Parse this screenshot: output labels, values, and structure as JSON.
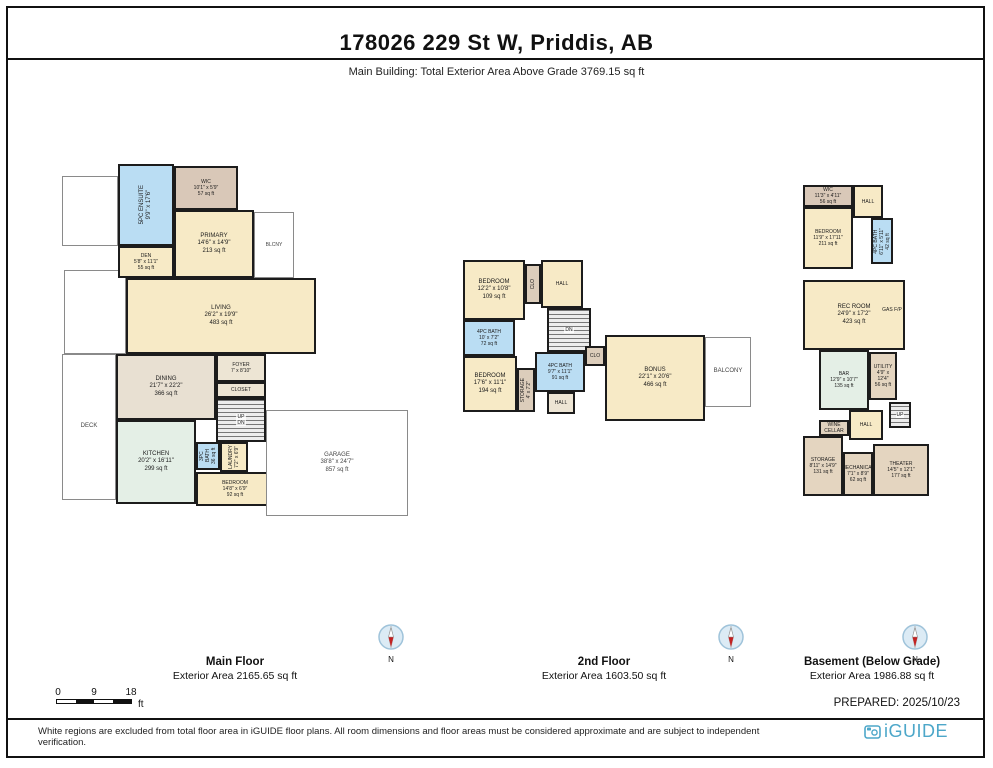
{
  "header": {
    "title": "178026 229 St W, Priddis, AB",
    "subtitle": "Main Building: Total Exterior Area Above Grade 3769.15 sq ft"
  },
  "compass": {
    "north_label": "N"
  },
  "scale_bar": {
    "ticks": [
      "0",
      "9",
      "18"
    ],
    "unit": "ft"
  },
  "prepared": "PREPARED: 2025/10/23",
  "footer": {
    "disclaimer": "White regions are excluded from total floor area in iGUIDE floor plans. All room dimensions and floor areas must be considered approximate and are subject to independent verification.",
    "logo_text": "iGUIDE"
  },
  "colors": {
    "room_cream": "#F7EAC6",
    "bath_blue": "#BADDF3",
    "closet_tan": "#DCCDBB",
    "hall_tan": "#EDE5D4",
    "dining_taupe": "#E8E0D2",
    "kitchen_mint": "#E4EFE6",
    "basement_tan": "#E4D5C0",
    "logo_blue": "#4DA7C9",
    "compass_red": "#C22222",
    "wall": "#1C1C1C"
  },
  "floors": [
    {
      "id": "main-floor",
      "caption_title": "Main Floor",
      "caption_area": "Exterior Area 2165.65 sq ft",
      "plan": {
        "left": 60,
        "top": 150,
        "width": 360,
        "height": 372
      },
      "rooms": [
        {
          "id": "deck-upper-region",
          "kind": "open",
          "lines": [],
          "x": 2,
          "y": 26,
          "w": 56,
          "h": 70
        },
        {
          "id": "deck-mid-region",
          "kind": "open",
          "lines": [],
          "x": 4,
          "y": 120,
          "w": 62,
          "h": 84
        },
        {
          "id": "deck",
          "kind": "open",
          "lines": [
            "DECK"
          ],
          "x": 2,
          "y": 204,
          "w": 54,
          "h": 146
        },
        {
          "id": "ensuite-5pc",
          "kind": "room",
          "vertical": true,
          "lines": [
            "5PC ENSUITE",
            "9'9\" x 17'6\""
          ],
          "x": 58,
          "y": 14,
          "w": 56,
          "h": 82,
          "fill": "#BADDF3"
        },
        {
          "id": "wic-main",
          "kind": "room",
          "lines": [
            "WIC",
            "10'1\" x 5'9\"",
            "57 sq ft"
          ],
          "x": 114,
          "y": 16,
          "w": 64,
          "h": 44,
          "fill": "#D9C8B8",
          "fs": 5
        },
        {
          "id": "primary-bedroom",
          "kind": "room",
          "lines": [
            "PRIMARY",
            "14'6\" x 14'9\"",
            "213 sq ft"
          ],
          "x": 114,
          "y": 60,
          "w": 80,
          "h": 68,
          "fill": "#F7EAC6"
        },
        {
          "id": "balcony-main",
          "kind": "open",
          "lines": [
            "BLCNY"
          ],
          "x": 194,
          "y": 62,
          "w": 40,
          "h": 66,
          "fs": 5
        },
        {
          "id": "den",
          "kind": "room",
          "lines": [
            "DEN",
            "5'8\" x 11'1\"",
            "55 sq ft"
          ],
          "x": 58,
          "y": 96,
          "w": 56,
          "h": 32,
          "fill": "#F7EAC6",
          "fs": 5
        },
        {
          "id": "living",
          "kind": "room",
          "lines": [
            "LIVING",
            "26'2\" x 19'9\"",
            "483 sq ft"
          ],
          "x": 66,
          "y": 128,
          "w": 190,
          "h": 76,
          "fill": "#F7EAC6"
        },
        {
          "id": "dining",
          "kind": "room",
          "lines": [
            "DINING",
            "21'7\" x 22'2\"",
            "366 sq ft"
          ],
          "x": 56,
          "y": 204,
          "w": 100,
          "h": 66,
          "fill": "#E8E0D2"
        },
        {
          "id": "foyer",
          "kind": "room",
          "lines": [
            "FOYER",
            "7' x 8'10\""
          ],
          "x": 156,
          "y": 204,
          "w": 50,
          "h": 28,
          "fill": "#EDE5D4",
          "fs": 5
        },
        {
          "id": "closet-main",
          "kind": "room",
          "lines": [
            "CLOSET"
          ],
          "x": 156,
          "y": 232,
          "w": 50,
          "h": 16,
          "fill": "#EDE5D4",
          "fs": 5
        },
        {
          "id": "stairs-main",
          "kind": "stairs",
          "lines": [
            "UP",
            "DN"
          ],
          "x": 156,
          "y": 248,
          "w": 50,
          "h": 44
        },
        {
          "id": "kitchen",
          "kind": "room",
          "lines": [
            "KITCHEN",
            "20'2\" x 16'11\"",
            "299 sq ft"
          ],
          "x": 56,
          "y": 270,
          "w": 80,
          "h": 84,
          "fill": "#E4EFE6"
        },
        {
          "id": "bath-3pc-main",
          "kind": "room",
          "vertical": true,
          "lines": [
            "3PC BATH",
            "36 sq ft"
          ],
          "x": 136,
          "y": 292,
          "w": 24,
          "h": 28,
          "fill": "#BADDF3",
          "fs": 5
        },
        {
          "id": "laundry",
          "kind": "room",
          "vertical": true,
          "lines": [
            "LAUNDRY",
            "7'2\" x 6'9\""
          ],
          "x": 160,
          "y": 292,
          "w": 28,
          "h": 30,
          "fill": "#F7EAC6",
          "fs": 5
        },
        {
          "id": "bedroom-main",
          "kind": "room",
          "lines": [
            "BEDROOM",
            "14'8\" x 6'9\"",
            "92 sq ft"
          ],
          "x": 136,
          "y": 322,
          "w": 78,
          "h": 34,
          "fill": "#F7EAC6",
          "fs": 5
        },
        {
          "id": "garage",
          "kind": "open",
          "lines": [
            "GARAGE",
            "38'8\" x 24'7\"",
            "857 sq ft"
          ],
          "x": 206,
          "y": 260,
          "w": 142,
          "h": 106
        }
      ]
    },
    {
      "id": "second-floor",
      "caption_title": "2nd Floor",
      "caption_area": "Exterior Area 1603.50 sq ft",
      "plan": {
        "left": 455,
        "top": 250,
        "width": 300,
        "height": 185
      },
      "rooms": [
        {
          "id": "bedroom-2a",
          "kind": "room",
          "lines": [
            "BEDROOM",
            "12'2\" x 10'8\"",
            "109 sq ft"
          ],
          "x": 8,
          "y": 10,
          "w": 62,
          "h": 60,
          "fill": "#F7EAC6"
        },
        {
          "id": "closet-2a",
          "kind": "room",
          "vertical": true,
          "lines": [
            "CLO"
          ],
          "x": 70,
          "y": 14,
          "w": 16,
          "h": 40,
          "fill": "#DCCDBB",
          "fs": 5
        },
        {
          "id": "hall-2",
          "kind": "room",
          "lines": [
            "HALL"
          ],
          "x": 86,
          "y": 10,
          "w": 42,
          "h": 48,
          "fill": "#F7EAC6",
          "fs": 5
        },
        {
          "id": "stairs-2",
          "kind": "stairs",
          "lines": [
            "DN"
          ],
          "x": 92,
          "y": 58,
          "w": 44,
          "h": 44
        },
        {
          "id": "bath-4pc-2a",
          "kind": "room",
          "lines": [
            "4PC BATH",
            "10' x 7'2\"",
            "72 sq ft"
          ],
          "x": 8,
          "y": 70,
          "w": 52,
          "h": 36,
          "fill": "#BADDF3",
          "fs": 5
        },
        {
          "id": "bedroom-2b",
          "kind": "room",
          "lines": [
            "BEDROOM",
            "17'6\" x 11'1\"",
            "194 sq ft"
          ],
          "x": 8,
          "y": 106,
          "w": 54,
          "h": 56,
          "fill": "#F7EAC6"
        },
        {
          "id": "storage-2",
          "kind": "room",
          "vertical": true,
          "lines": [
            "STORAGE",
            "4' x 7'2\""
          ],
          "x": 62,
          "y": 118,
          "w": 18,
          "h": 44,
          "fill": "#DCCDBB",
          "fs": 5
        },
        {
          "id": "bath-4pc-2b",
          "kind": "room",
          "lines": [
            "4PC BATH",
            "9'7\" x 11'1\"",
            "91 sq ft"
          ],
          "x": 80,
          "y": 102,
          "w": 50,
          "h": 40,
          "fill": "#BADDF3",
          "fs": 5
        },
        {
          "id": "hall-2b",
          "kind": "room",
          "lines": [
            "HALL"
          ],
          "x": 92,
          "y": 142,
          "w": 28,
          "h": 22,
          "fill": "#EDE5D4",
          "fs": 5
        },
        {
          "id": "closet-2b",
          "kind": "room",
          "lines": [
            "CLO"
          ],
          "x": 130,
          "y": 96,
          "w": 20,
          "h": 20,
          "fill": "#DCCDBB",
          "fs": 5
        },
        {
          "id": "bonus-room",
          "kind": "room",
          "lines": [
            "BONUS",
            "22'1\" x 20'6\"",
            "466 sq ft"
          ],
          "x": 150,
          "y": 85,
          "w": 100,
          "h": 86,
          "fill": "#F7EAC6"
        },
        {
          "id": "balcony-2",
          "kind": "open",
          "lines": [
            "BALCONY"
          ],
          "x": 250,
          "y": 87,
          "w": 46,
          "h": 70
        }
      ]
    },
    {
      "id": "basement",
      "caption_title": "Basement (Below Grade)",
      "caption_area": "Exterior Area 1986.88 sq ft",
      "plan": {
        "left": 795,
        "top": 180,
        "width": 145,
        "height": 330
      },
      "rooms": [
        {
          "id": "wic-basement",
          "kind": "room",
          "lines": [
            "WIC",
            "11'3\" x 4'11\"",
            "56 sq ft"
          ],
          "x": 8,
          "y": 5,
          "w": 50,
          "h": 22,
          "fill": "#D9C8B8",
          "fs": 5
        },
        {
          "id": "bedroom-basement",
          "kind": "room",
          "lines": [
            "BEDROOM",
            "11'9\" x 17'11\"",
            "211 sq ft"
          ],
          "x": 8,
          "y": 27,
          "w": 50,
          "h": 62,
          "fill": "#F7EAC6",
          "fs": 5
        },
        {
          "id": "hall-basement-upper",
          "kind": "room",
          "lines": [
            "HALL"
          ],
          "x": 58,
          "y": 5,
          "w": 30,
          "h": 33,
          "fill": "#F7EAC6",
          "fs": 5
        },
        {
          "id": "bath-4pc-basement",
          "kind": "room",
          "vertical": true,
          "lines": [
            "4PC BATH",
            "6'11\" x 5'11\"",
            "42 sq ft"
          ],
          "x": 76,
          "y": 38,
          "w": 22,
          "h": 46,
          "fill": "#BADDF3",
          "fs": 5
        },
        {
          "id": "rec-room",
          "kind": "room",
          "lines": [
            "REC ROOM",
            "24'9\" x 17'2\"",
            "423 sq ft"
          ],
          "x": 8,
          "y": 100,
          "w": 102,
          "h": 70,
          "fill": "#F7EAC6"
        },
        {
          "id": "gas-fireplace",
          "kind": "label",
          "lines": [
            "GAS F/P"
          ],
          "x": 86,
          "y": 124,
          "w": 22,
          "h": 12,
          "fs": 5
        },
        {
          "id": "bar",
          "kind": "room",
          "lines": [
            "BAR",
            "12'9\" x 10'7\"",
            "135 sq ft"
          ],
          "x": 24,
          "y": 170,
          "w": 50,
          "h": 60,
          "fill": "#E4EFE6",
          "fs": 5
        },
        {
          "id": "utility",
          "kind": "room",
          "lines": [
            "UTILITY",
            "4'9\" x 12'4\"",
            "56 sq ft"
          ],
          "x": 74,
          "y": 172,
          "w": 28,
          "h": 48,
          "fill": "#E4D5C0",
          "fs": 5
        },
        {
          "id": "wine-cellar",
          "kind": "room",
          "lines": [
            "WINE CELLAR"
          ],
          "x": 24,
          "y": 240,
          "w": 30,
          "h": 16,
          "fill": "#E0D2BF",
          "fs": 5
        },
        {
          "id": "hall-basement-lower",
          "kind": "room",
          "lines": [
            "HALL"
          ],
          "x": 54,
          "y": 230,
          "w": 34,
          "h": 30,
          "fill": "#F7EAC6",
          "fs": 5
        },
        {
          "id": "stairs-basement",
          "kind": "stairs",
          "lines": [
            "UP"
          ],
          "x": 94,
          "y": 222,
          "w": 22,
          "h": 26
        },
        {
          "id": "storage-basement",
          "kind": "room",
          "lines": [
            "STORAGE",
            "8'11\" x 14'9\"",
            "131 sq ft"
          ],
          "x": 8,
          "y": 256,
          "w": 40,
          "h": 60,
          "fill": "#E4D5C0",
          "fs": 5
        },
        {
          "id": "mechanical",
          "kind": "room",
          "lines": [
            "MECHANICAL",
            "7'1\" x 8'9\"",
            "62 sq ft"
          ],
          "x": 48,
          "y": 272,
          "w": 30,
          "h": 44,
          "fill": "#E4D5C0",
          "fs": 5
        },
        {
          "id": "theater",
          "kind": "room",
          "lines": [
            "THEATER",
            "14'5\" x 12'1\"",
            "177 sq ft"
          ],
          "x": 78,
          "y": 264,
          "w": 56,
          "h": 52,
          "fill": "#E4D5C0",
          "fs": 5
        }
      ]
    }
  ]
}
